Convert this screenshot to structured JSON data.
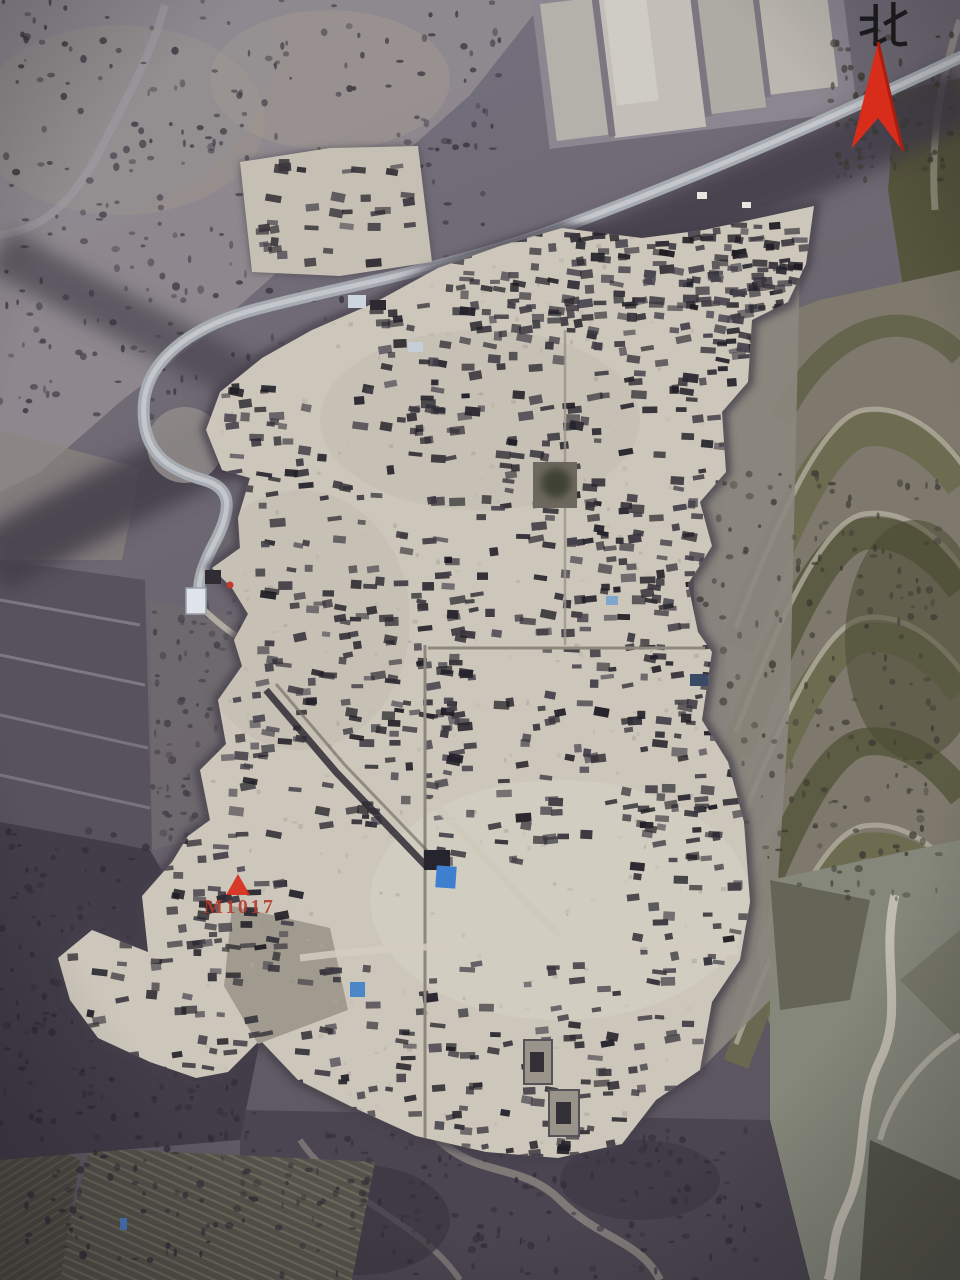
{
  "annotations": {
    "north_label": "北",
    "north_arrow_icon": "north-arrow",
    "tomb_marker_label": "M1017",
    "tomb_marker_icon": "red-triangle"
  },
  "colors": {
    "annotation_red": "#d92d1c",
    "tomb_label_red": "#b5392b",
    "tarp_blue": "#3f7fd0",
    "site_surface": "#cdc7bb",
    "road_gray": "#a7abb2",
    "vegetation_dark": "#433e4a",
    "terrace_olive": "#5f5e44"
  }
}
